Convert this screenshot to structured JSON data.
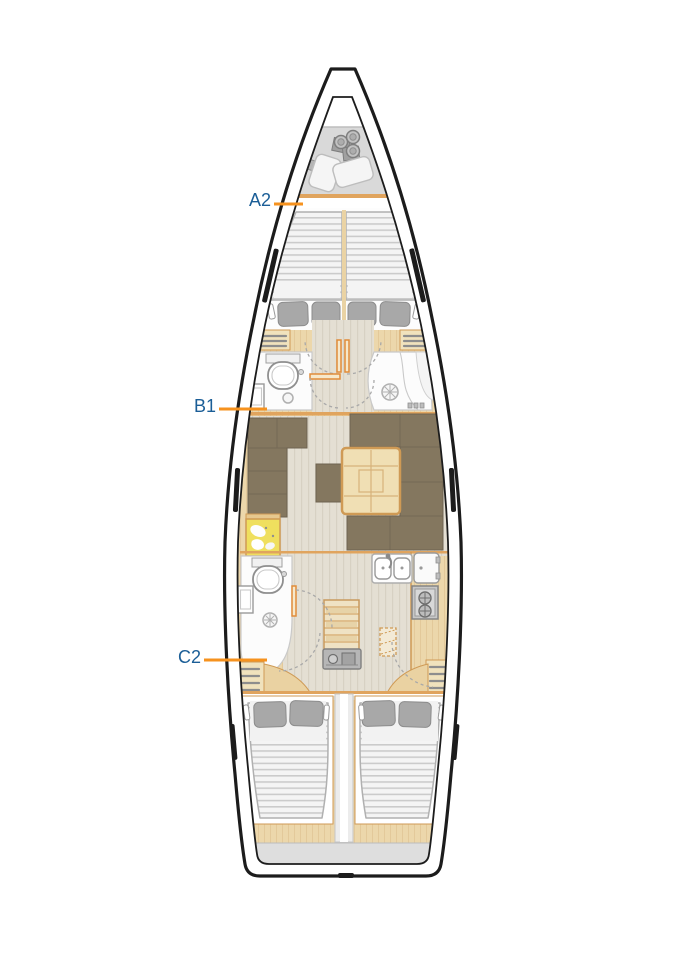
{
  "diagram": {
    "type": "sailing-yacht-deck-plan",
    "labels": {
      "a2": "A2",
      "b1": "B1",
      "c2": "C2"
    },
    "colors": {
      "label_text": "#1b5e97",
      "callout_line": "#f6921e",
      "hull_outline": "#1c1c1c",
      "wood_trim": "#ecd7ab",
      "wood_border": "#cf9a55",
      "floor": "#e4dfd3",
      "locker_gray": "#d9d9d9",
      "stern_gray": "#dedede",
      "sofa": "#84775f",
      "sofa_line": "#6e6350",
      "pillow": "#a8a8a8",
      "table": "#f0dfb4",
      "chart_map": "#efdf5e",
      "appliance_gray": "#c7c7c7",
      "door_orange": "#e08c3a"
    }
  }
}
